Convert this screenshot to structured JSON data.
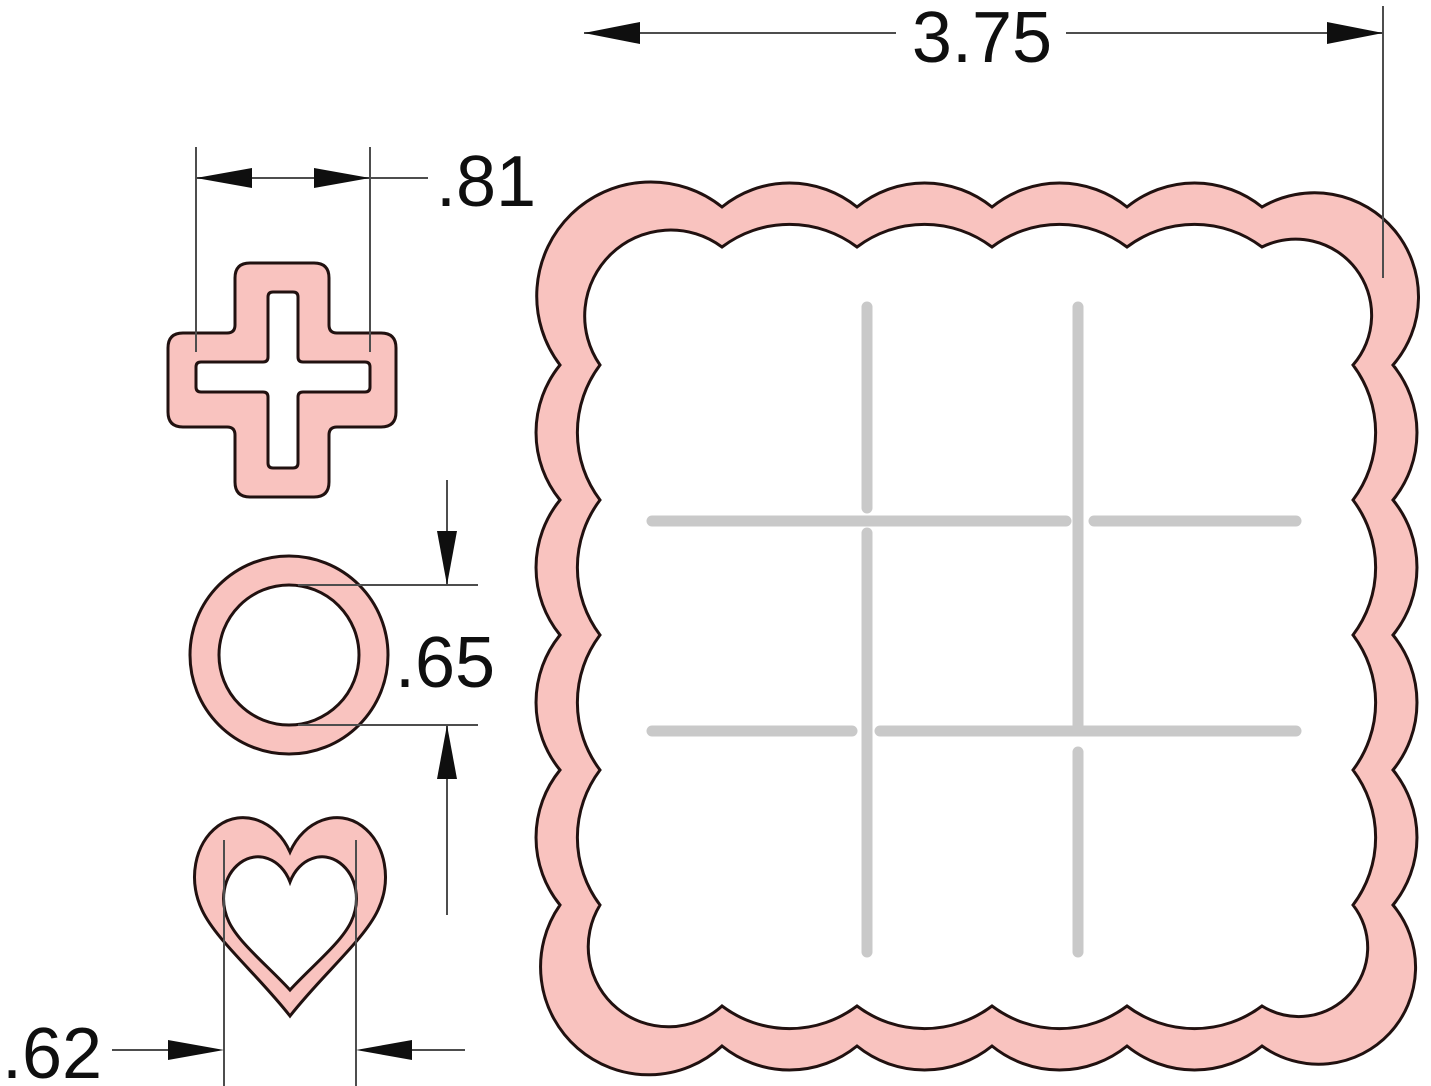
{
  "document": {
    "type": "dimensioned technical drawing",
    "subject": "tic-tac-toe cookie cutter and stamp set",
    "units": "inches"
  },
  "colors": {
    "pink": "#f9c3bf",
    "outline": "#211110",
    "grid": "#c9c9c9",
    "dim": "#4d4d4d",
    "ink": "#0f0f0f",
    "background": "#ffffff"
  },
  "shapes": {
    "board": "scalloped square board cutter with tic-tac-toe grid slots",
    "plus_cutter": "plus / X marker cutter",
    "circle_cutter": "circle / O marker cutter",
    "heart_cutter": "heart marker cutter"
  },
  "dimensions": {
    "board_width": ".3.75",
    "board_width_label": "3.75",
    "plus_width_label": ".81",
    "circle_diameter_label": ".65",
    "heart_width_label": ".62"
  }
}
